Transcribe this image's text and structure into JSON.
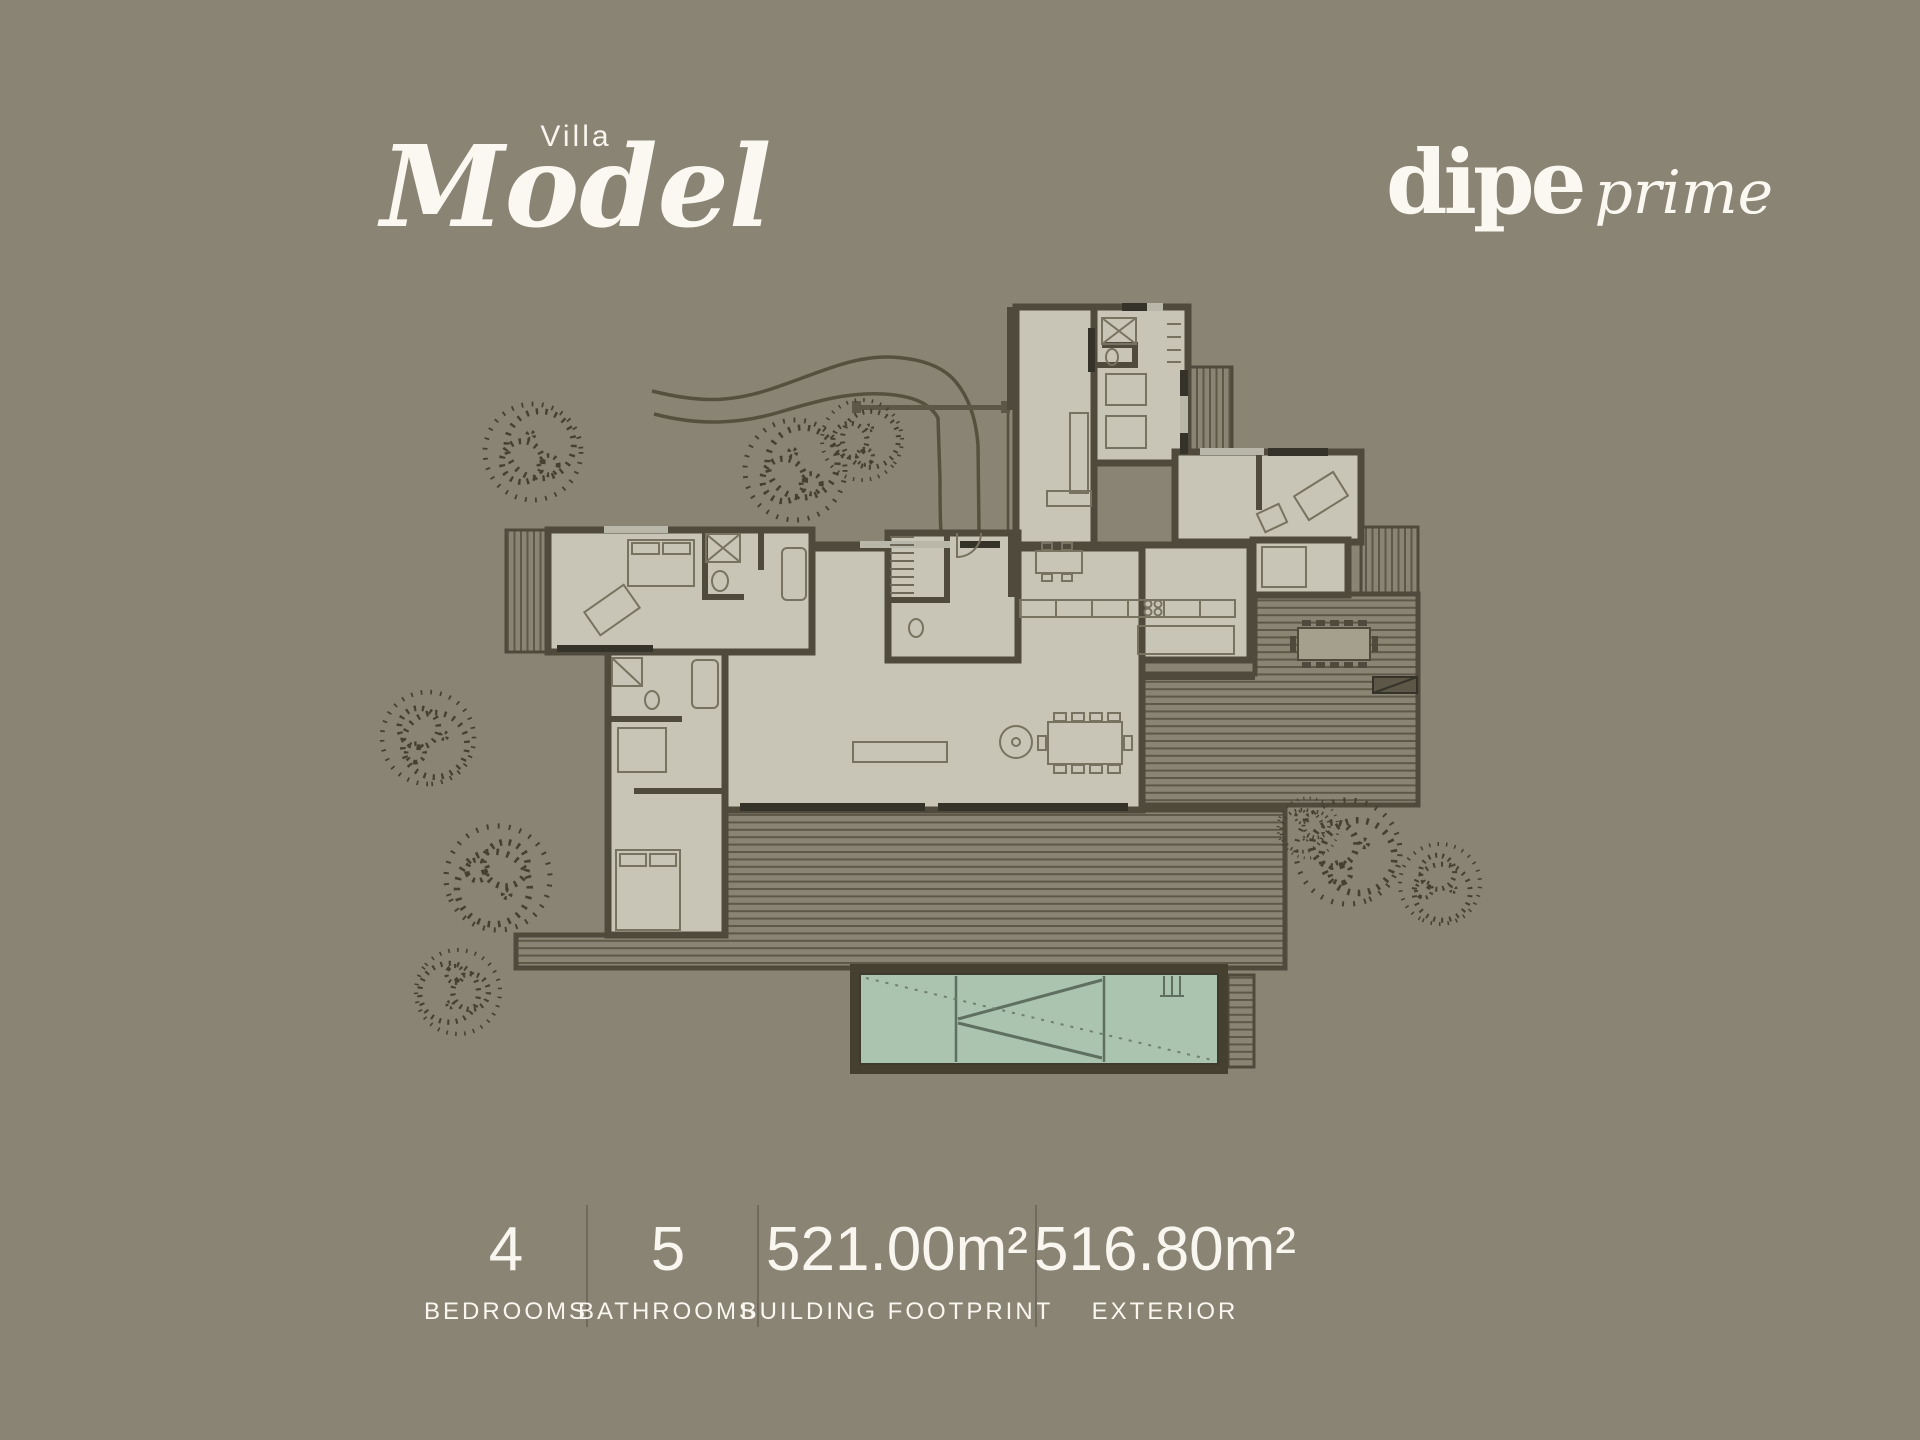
{
  "page": {
    "background_color": "#8a8474",
    "text_color": "#f8f6ef"
  },
  "header": {
    "subtitle": "Villa",
    "title": "Model"
  },
  "brand": {
    "name": "dipe",
    "suffix": "prime"
  },
  "stats": {
    "items": [
      {
        "value": "4",
        "label": "BEDROOMS"
      },
      {
        "value": "5",
        "label": "BATHROOMS"
      },
      {
        "value": "521.00m²",
        "label": "BUILDING FOOTPRINT"
      },
      {
        "value": "516.80m²",
        "label": "EXTERIOR"
      }
    ]
  },
  "floorplan": {
    "kind": "villa site plan, top view",
    "visible_features": [
      "house footprint",
      "wood decks",
      "swimming pool",
      "driveway",
      "trees"
    ],
    "colors": {
      "floor": "#c9c5b6",
      "walls": "#4f4a3c",
      "pool_water": "#abc4b0",
      "deck_stripe": "#5d5847",
      "trees": "#45402f"
    }
  }
}
